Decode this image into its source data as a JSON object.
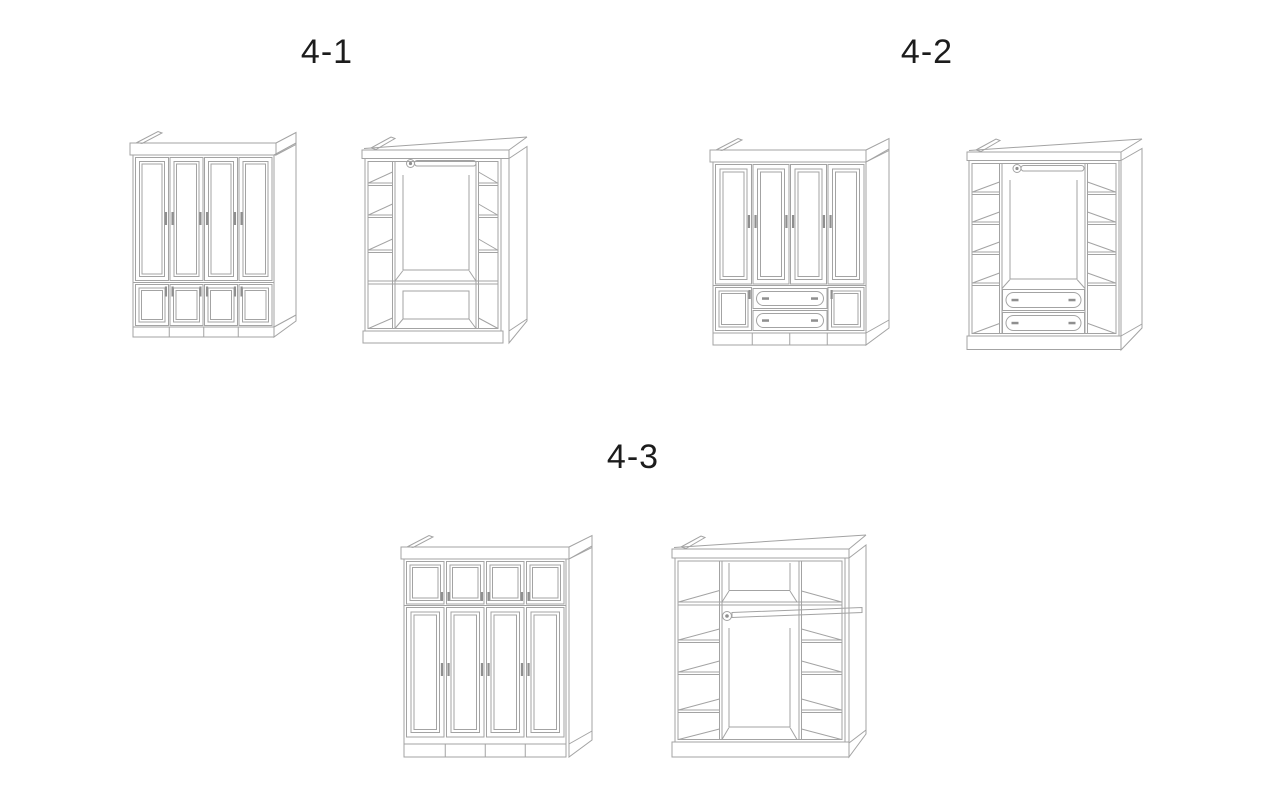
{
  "labels": [
    {
      "text": "4-1"
    },
    {
      "text": "4-2"
    },
    {
      "text": "4-3"
    }
  ],
  "colors": {
    "background": "#ffffff",
    "line": "#a3a3a3",
    "handle": "#8f8f8f",
    "text": "#1c1c1c"
  },
  "figures": [
    {
      "label": "4-1",
      "left_view": "wardrobe exterior: four framed doors with four small lower doors",
      "right_view": "wardrobe interior: left shelf column, center hanging rod, right shelf column, three bottom compartments"
    },
    {
      "label": "4-2",
      "left_view": "wardrobe exterior: four framed doors, two center drawers, two small lower doors",
      "right_view": "wardrobe interior: left shelf column, center hanging rod, right shelf column, two center drawers"
    },
    {
      "label": "4-3",
      "left_view": "wardrobe exterior: four small upper cabinet doors over four tall doors",
      "right_view": "wardrobe interior: full-width top shelf band, left shelf column, center hanging rod, right shelf column"
    }
  ]
}
